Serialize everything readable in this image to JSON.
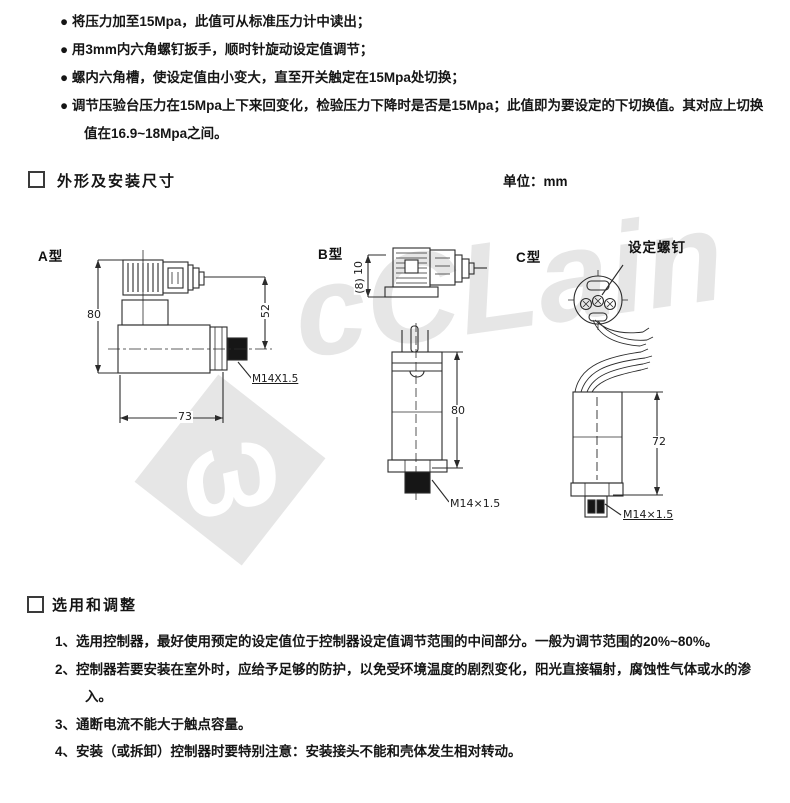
{
  "document": {
    "unit_label": "单位：mm",
    "bullet_list": [
      "将压力加至15Mpa，此值可从标准压力计中读出；",
      "用3mm内六角螺钉扳手，顺时针旋动设定值调节；",
      "螺内六角槽，使设定值由小变大，直至开关触定在15Mpa处切换；",
      "调节压验台压力在15Mpa上下来回变化，检验压力下降时是否是15Mpa；此值即为要设定的下切换值。其对应上切换值在16.9~18Mpa之间。"
    ],
    "section_dimensions": {
      "title": "外形及安装尺寸"
    },
    "section_adjustment": {
      "title": "选用和调整"
    },
    "numbered_list": [
      "1、选用控制器，最好使用预定的设定值位于控制器设定值调节范围的中间部分。一般为调节范围的20%~80%。",
      "2、控制器若要安装在室外时，应给予足够的防护，以免受环境温度的剧烈变化，阳光直接辐射，腐蚀性气体或水的渗入。",
      "3、通断电流不能大于触点容量。",
      "4、安装（或拆卸）控制器时要特别注意：安装接头不能和壳体发生相对转动。"
    ]
  },
  "drawings": {
    "type_a": {
      "label": "A型",
      "dim_height": "80",
      "dim_side": "52",
      "dim_width": "73",
      "thread": "M14X1.5"
    },
    "type_b": {
      "label": "B型",
      "dim_top": "10",
      "dim_top_alt": "(8)",
      "dim_height": "80",
      "thread": "M14×1.5"
    },
    "type_c": {
      "label": "C型",
      "screw_label": "设定螺钉",
      "dim_height": "72",
      "thread": "M14×1.5"
    }
  },
  "watermark": {
    "symbol": "ω",
    "text": "cCLain"
  },
  "colors": {
    "line": "#2b2b2b",
    "watermark": "#e6e6e6",
    "text": "#151515"
  }
}
